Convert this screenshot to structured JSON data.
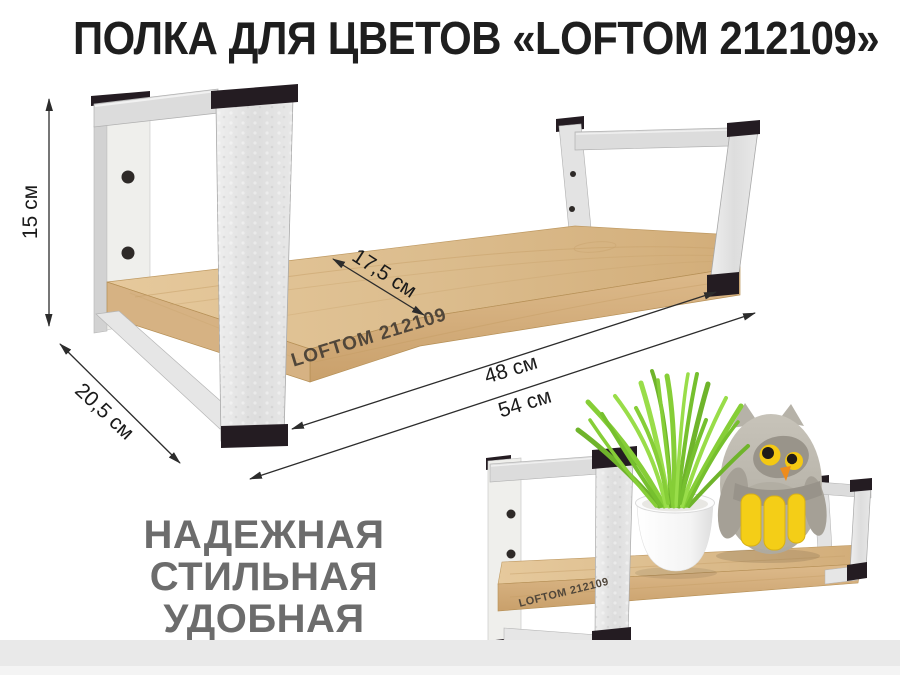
{
  "title": "ПОЛКА ДЛЯ ЦВЕТОВ «LOFTOM 212109»",
  "dimension_labels": {
    "height": "15 см",
    "side_depth": "20,5 см",
    "shelf_depth": "17,5 см",
    "shelf_length": "48 см",
    "overall_length": "54 см"
  },
  "engravings": {
    "main_board": "LOFTOM 212109",
    "small_board": "LOFTOM 212109"
  },
  "features": [
    "НАДЕЖНАЯ",
    "СТИЛЬНАЯ",
    "УДОБНАЯ"
  ],
  "colors": {
    "background": "#ffffff",
    "title_text": "#1e1e1e",
    "dimension_text": "#1a1a1a",
    "features_text": "#6c6c6c",
    "engraving_text": "#50463a",
    "metal_silver": "#e2e2e2",
    "end_cap_black": "#241c22",
    "wood_light_oak": "#d9b98c",
    "grass_green": "#7fc92e",
    "pot_white": "#fcfcfc",
    "owl_gray": "#bdb9af",
    "owl_yellow": "#f4ce17",
    "owl_beak_orange": "#ee8c1c",
    "bottom_band": "#e9e9e9"
  }
}
